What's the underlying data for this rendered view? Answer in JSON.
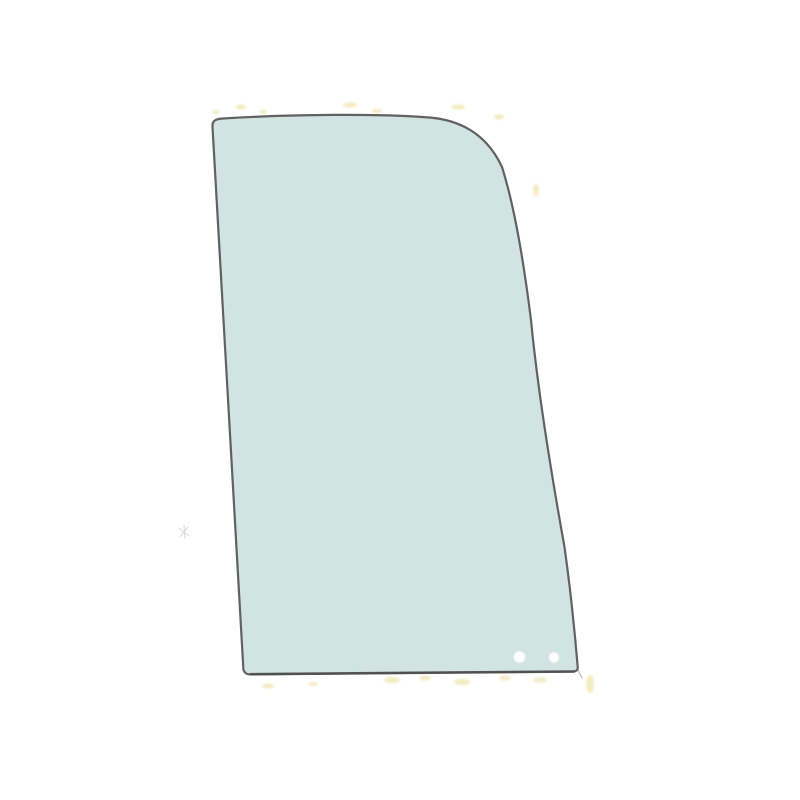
{
  "canvas": {
    "width": 800,
    "height": 800,
    "background_color": "#ffffff"
  },
  "glass_panel": {
    "fill_color": "#d1e4e1",
    "outline_color": "#616161",
    "outline_width": 2.2,
    "outline_path": "M 212.5 127 C 212 121.5 214.5 118.9 223 118.5 C 292 114.2 382 113.5 431 117.6 C 466 121 489 139 502 167 C 514 205 523 256 531 320 C 538 393 551 472 564.5 547 C 570 586 574.5 629 577.6 666 Q 578.6 670.6 574 671.5 L 252 674.3 Q 245 675.2 243.4 669.5 Z",
    "bottom_edge": {
      "path": "M 573.5 671.5 L 251 674.2",
      "color": "#4e4e4e",
      "width": 2.6
    },
    "corner_spur": {
      "path": "M 578.3 670.5 L 582 678",
      "color": "#9a9a9a",
      "width": 1.2
    },
    "holes": [
      {
        "cx": 519.5,
        "cy": 657,
        "r": 5.8,
        "fill": "#fcfdfd"
      },
      {
        "cx": 554,
        "cy": 657.5,
        "r": 5.2,
        "fill": "#fcfdfd"
      }
    ]
  },
  "artifacts": {
    "speck_color": "#e9da8f",
    "smudge_color": "#bdbdbd"
  }
}
